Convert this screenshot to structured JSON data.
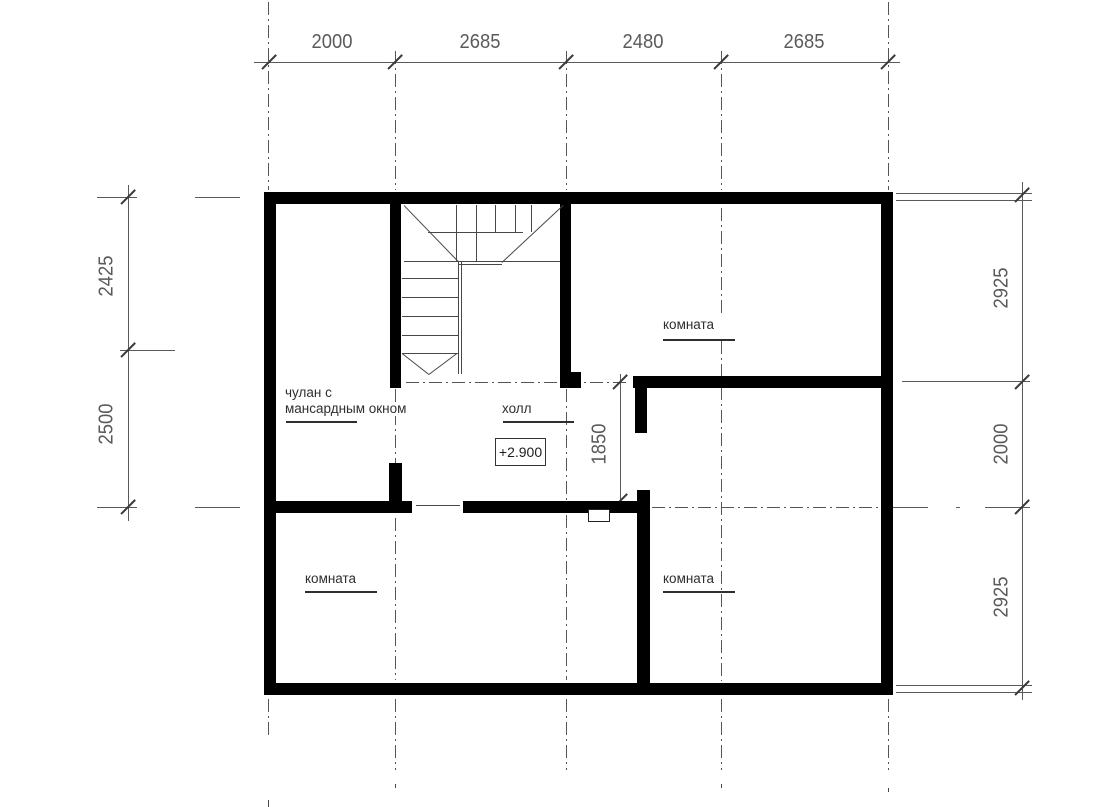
{
  "dimensions": {
    "top": [
      "2000",
      "2685",
      "2480",
      "2685"
    ],
    "left": [
      "2425",
      "2500"
    ],
    "right": [
      "2925",
      "2000",
      "2925"
    ],
    "door_opening": "1850"
  },
  "rooms": {
    "closet_label_line1": "чулан с",
    "closet_label_line2": "мансардным окном",
    "hall_label": "холл",
    "room_top_right_label": "комната",
    "room_bottom_left_label": "комната",
    "room_bottom_right_label": "комната"
  },
  "elevation_mark": "+2.900",
  "colors": {
    "wall": "#000000",
    "thin_line": "#474747",
    "dim_line": "#5a5a5a",
    "dim_text": "#5a5a5a",
    "label_text": "#2e2e2e",
    "background": "#ffffff"
  }
}
